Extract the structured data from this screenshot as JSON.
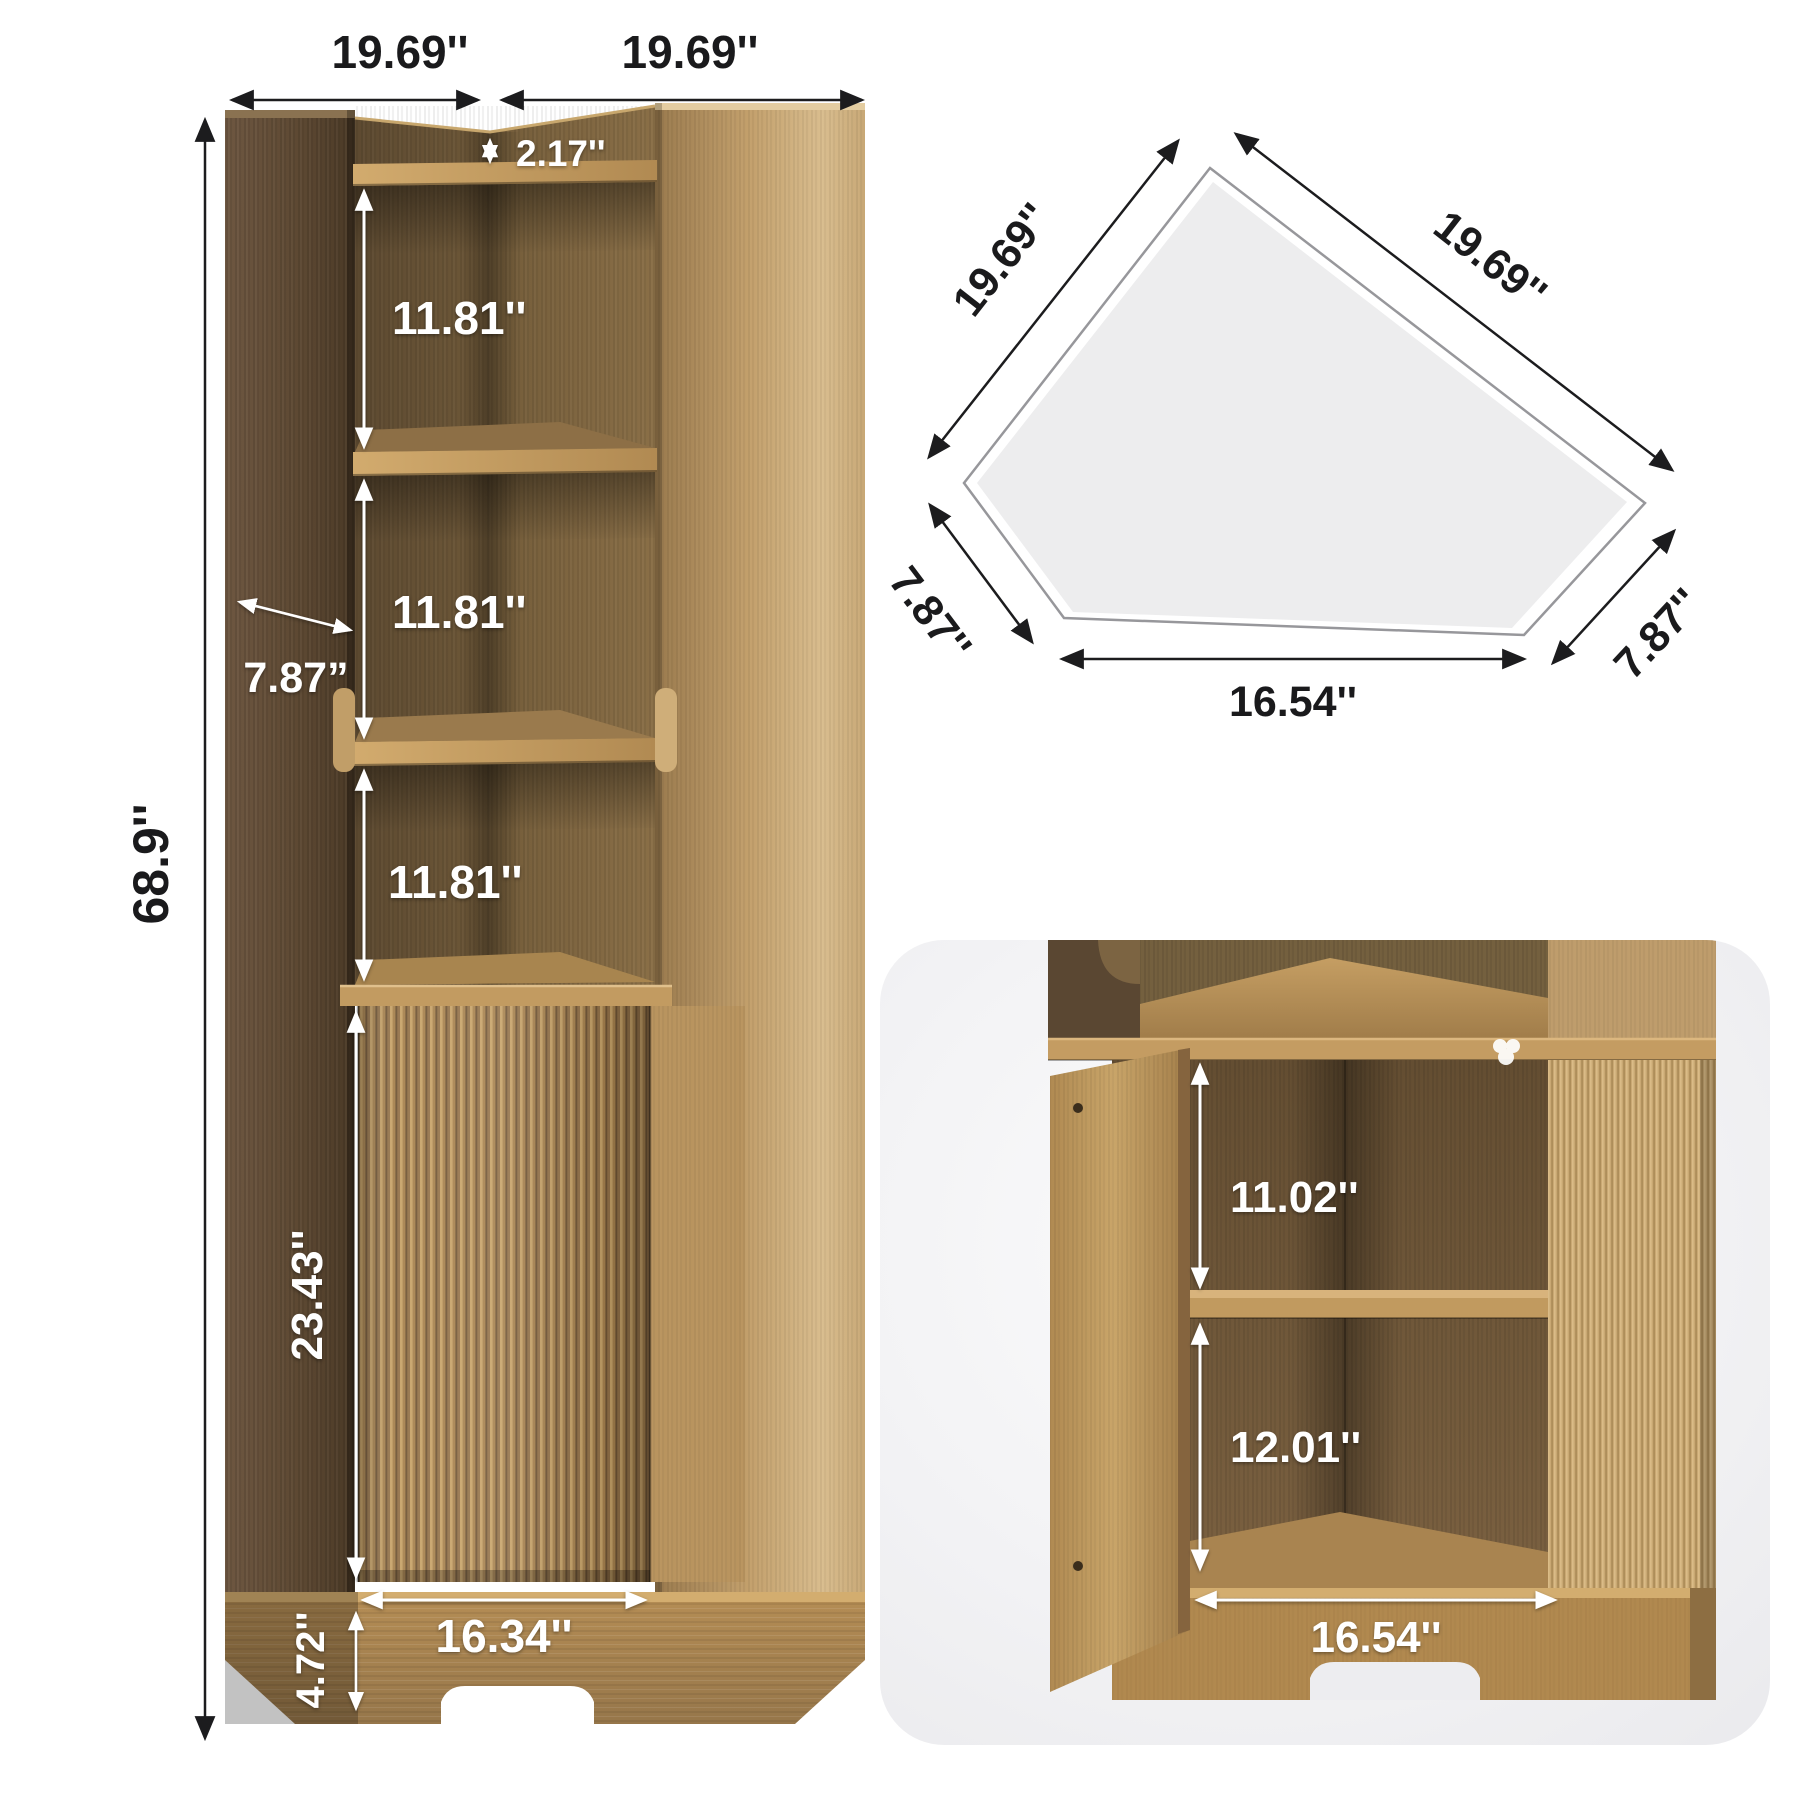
{
  "image_type": "product dimension diagram",
  "product": "corner storage cabinet with open shelves and fluted door",
  "main_view": {
    "top_width_left": "19.69''",
    "top_width_right": "19.69''",
    "top_gap_height": "2.17''",
    "upper_shelf_height": "11.81''",
    "middle_shelf_height": "11.81''",
    "lower_shelf_height": "11.81''",
    "side_panel_depth": "7.87”",
    "total_height": "68.9''",
    "door_height": "23.43''",
    "door_width": "16.34''",
    "base_height": "4.72''"
  },
  "top_view": {
    "back_edge_left": "19.69''",
    "back_edge_right": "19.69''",
    "front_side_left": "7.87''",
    "front_side_right": "7.87''",
    "front_edge": "16.54''"
  },
  "detail_view": {
    "upper_compartment_height": "11.02''",
    "lower_compartment_height": "12.01''",
    "compartment_width": "16.54''"
  },
  "palette": {
    "background": "#ffffff",
    "dimension_text_dark": "#1a1a1c",
    "dimension_text_light": "#ffffff",
    "arrow_dark": "#1c1c1e",
    "arrow_light": "#ffffff",
    "card_background": "#efeff1",
    "plan_fill": "#ededee",
    "plan_stroke": "#97979b",
    "wood_dark": "#5a4731",
    "wood_medium": "#7a6142",
    "wood_light": "#c9a873",
    "wood_honey": "#c49c62"
  }
}
